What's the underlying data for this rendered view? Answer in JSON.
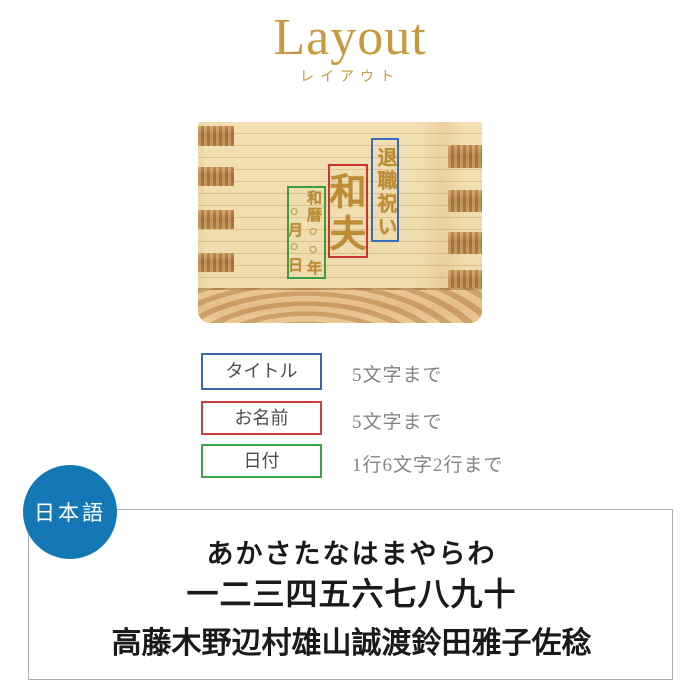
{
  "header": {
    "title": "Layout",
    "subtitle": "レイアウト",
    "accent_color": "#c8993f"
  },
  "product_photo": {
    "description": "wooden-masu-box-engraving-sample",
    "engraving": {
      "title_vertical": "退職祝い",
      "name_vertical": "和夫",
      "date_column_right": "和暦○○年",
      "date_column_left": "○月○日",
      "text_color": "#bd8c33"
    },
    "highlight_colors": {
      "title_box": "#3a6cc0",
      "name_box": "#cc3333",
      "date_box": "#3a9e42"
    }
  },
  "legend": {
    "rows": [
      {
        "label": "タイトル",
        "limit": "5文字まで",
        "border_color": "#3a68ac"
      },
      {
        "label": "お名前",
        "limit": "5文字まで",
        "border_color": "#c94040"
      },
      {
        "label": "日付",
        "limit": "1行6文字2行まで",
        "border_color": "#3da24a"
      }
    ]
  },
  "language_badge": {
    "label": "日本語",
    "background_color": "#1478b6"
  },
  "font_sample": {
    "lines": [
      "あかさたなはまやらわ",
      "一二三四五六七八九十",
      "高藤木野辺村雄山誠渡鈴田雅子佐稔"
    ]
  }
}
